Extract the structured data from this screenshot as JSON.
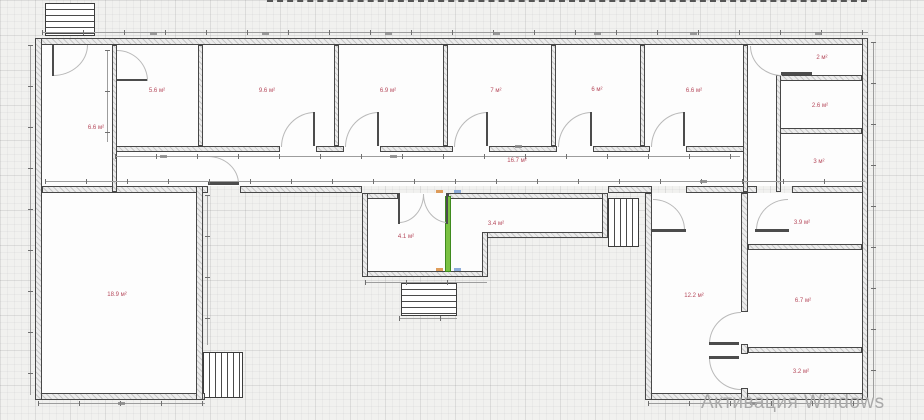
{
  "app": {
    "watermark": "Активация Windows"
  },
  "plan": {
    "unit": "м²",
    "rooms": [
      {
        "name": "hall-left",
        "label": "6.6 м²"
      },
      {
        "name": "top-room-1",
        "label": "5.6 м²"
      },
      {
        "name": "top-room-2",
        "label": "9.6 м²"
      },
      {
        "name": "top-room-3",
        "label": "6.9 м²"
      },
      {
        "name": "top-room-4",
        "label": "7 м²"
      },
      {
        "name": "top-room-5",
        "label": "6 м²"
      },
      {
        "name": "top-room-6",
        "label": "6.6 м²"
      },
      {
        "name": "right-col-1",
        "label": "2 м²"
      },
      {
        "name": "right-col-2",
        "label": "2.6 м²"
      },
      {
        "name": "right-col-3",
        "label": "3 м²"
      },
      {
        "name": "corridor",
        "label": "16.7 м²"
      },
      {
        "name": "mid-room-1",
        "label": "4.1 м²"
      },
      {
        "name": "mid-room-2",
        "label": "3.4 м²"
      },
      {
        "name": "big-left-room",
        "label": "18.9 м²"
      },
      {
        "name": "right-section",
        "label": "12.2 м²"
      },
      {
        "name": "rs-room-top",
        "label": "3.9 м²"
      },
      {
        "name": "rs-room-mid",
        "label": "6.7 м²"
      },
      {
        "name": "rs-room-bottom",
        "label": "3.2 м²"
      }
    ],
    "colors": {
      "room_label": "#b5495b",
      "selected_wall": "#7ac142",
      "watermark": "#a9a9a9"
    }
  }
}
